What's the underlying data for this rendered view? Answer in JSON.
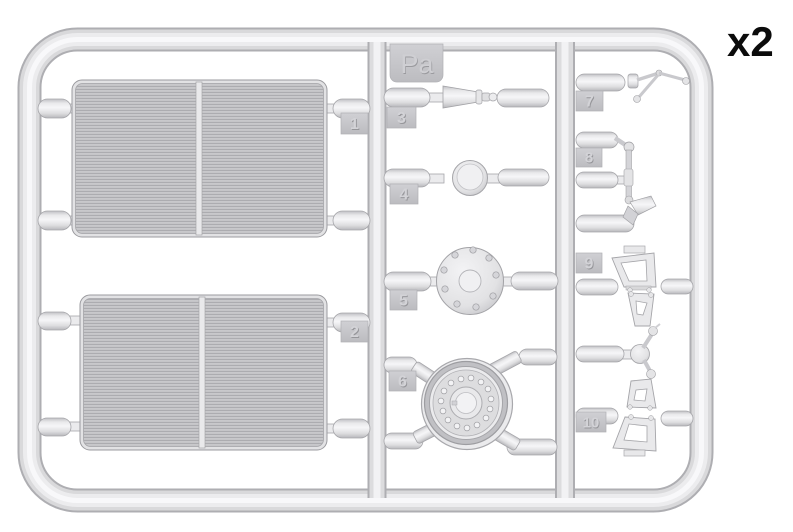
{
  "sprue": {
    "code": "Pa",
    "multiplier": "x2",
    "parts": [
      {
        "tag": "1",
        "shape": "radiator-panel"
      },
      {
        "tag": "2",
        "shape": "radiator-panel"
      },
      {
        "tag": "3",
        "shape": "cone-nozzle"
      },
      {
        "tag": "4",
        "shape": "small-disc"
      },
      {
        "tag": "5",
        "shape": "bolted-flange-disc"
      },
      {
        "tag": "6",
        "shape": "drum-wheel"
      },
      {
        "tag": "7",
        "shape": "ball-lever-linkage"
      },
      {
        "tag": "8",
        "shape": "rod-linkage"
      },
      {
        "tag": "9",
        "shape": "pedal-bracket"
      },
      {
        "tag": "10",
        "shape": "pedal-bracket"
      }
    ],
    "colors": {
      "plastic_mid": "#d9d9db",
      "plastic_light": "#f5f5f7",
      "plastic_dark": "#b2b2b6",
      "background": "#ffffff",
      "label_text": "#0b0b0b"
    }
  }
}
